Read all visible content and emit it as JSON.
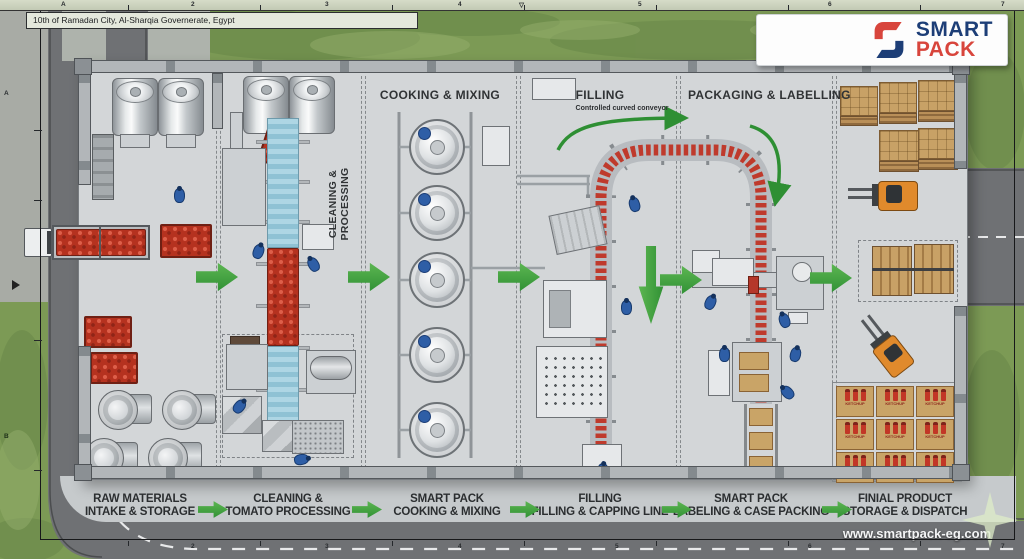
{
  "meta": {
    "address": "10th of Ramadan City, Al-Sharqia Governerate, Egypt",
    "website": "www.smartpack-eg.com"
  },
  "logo": {
    "word1": "SMART",
    "word2": "PACK"
  },
  "colors": {
    "accent_green": "#2e8f33",
    "logo_navy": "#1d3e77",
    "logo_red": "#d8453c",
    "grass": "#7c9a55",
    "road": "#6f7174",
    "floor": "#d3d6d8",
    "tomato": "#b5321f",
    "carton": "#c9a467",
    "conveyor_blue": "#a5d0e0",
    "worker_blue": "#2e5ea6",
    "forklift_orange": "#e08a2c"
  },
  "ruler": {
    "top": [
      "A",
      "2",
      "3",
      "4",
      "▽",
      "5",
      "6",
      "7"
    ],
    "left": [
      "A",
      "B"
    ],
    "bottom": [
      "2",
      "3",
      "4",
      "5",
      "6",
      "7"
    ]
  },
  "zones": {
    "cleaning": {
      "line1": "CLEANING &",
      "line2": "PROCESSING"
    },
    "cooking": "COOKING & MIXING",
    "filling": "FILLING",
    "packaging": "PACKAGING & LABELLING"
  },
  "annotations": {
    "curved_conveyor": "Controlled curved conveyor"
  },
  "stages": [
    {
      "line1": "RAW MATERIALS",
      "line2": "INTAKE & STORAGE"
    },
    {
      "line1": "CLEANING &",
      "line2": "TOMATO PROCESSING"
    },
    {
      "line1": "SMART PACK",
      "line2": "COOKING & MIXING"
    },
    {
      "line1": "FILLING",
      "line2": "FILLING & CAPPING LINE"
    },
    {
      "line1": "SMART PACK",
      "line2": "LABELING & CASE PACKING"
    },
    {
      "line1": "FINIAL PRODUCT",
      "line2": "STORAGE & DISPATCH"
    }
  ],
  "storage": {
    "carton_text": "KETCHUP"
  }
}
